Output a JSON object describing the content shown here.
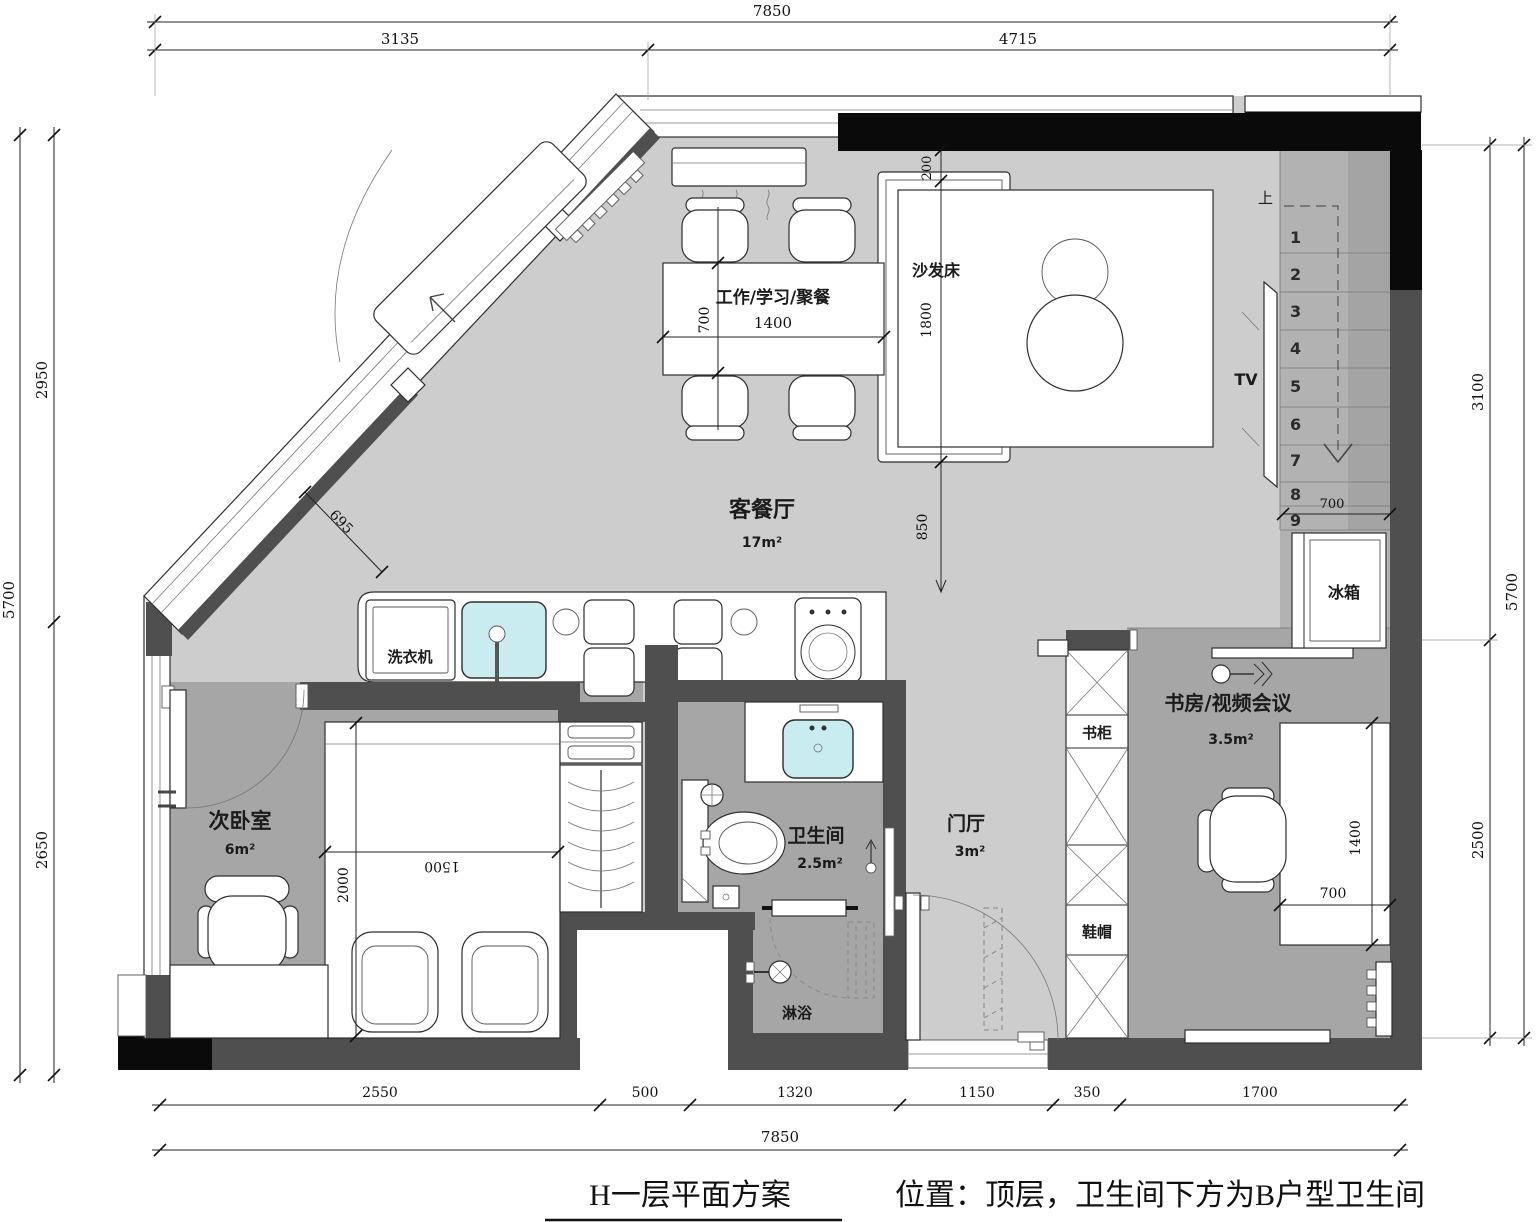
{
  "title": {
    "plan": "H一层平面方案",
    "note": "位置：顶层，卫生间下方为B户型卫生间"
  },
  "rooms": {
    "living": {
      "name": "客餐厅",
      "area": "17m²"
    },
    "bedroom": {
      "name": "次卧室",
      "area": "6m²"
    },
    "bathroom": {
      "name": "卫生间",
      "area": "2.5m²"
    },
    "hall": {
      "name": "门厅",
      "area": "3m²"
    },
    "study": {
      "name": "书房/视频会议",
      "area": "3.5m²"
    },
    "shower": {
      "name": "淋浴"
    }
  },
  "furniture": {
    "sofa_bed": "沙发床",
    "work_table": "工作/学习/聚餐",
    "washer": "洗衣机",
    "fridge": "冰箱",
    "tv": "TV",
    "bookcase": "书柜",
    "shoe_cabinet": "鞋帽"
  },
  "stairs": {
    "up": "上",
    "width": "700",
    "steps": [
      "1",
      "2",
      "3",
      "4",
      "5",
      "6",
      "7",
      "8",
      "9"
    ]
  },
  "dims": {
    "top": {
      "overall": "7850",
      "left": "3135",
      "right": "4715"
    },
    "left": {
      "overall": "5700",
      "top": "2950",
      "bottom": "2650"
    },
    "right": {
      "overall": "5700",
      "top": "3100",
      "bottom": "2500"
    },
    "bottom": {
      "overall": "7850",
      "segments": [
        "2550",
        "500",
        "1320",
        "1150",
        "350",
        "1700"
      ]
    },
    "interior": {
      "table_len": "1400",
      "table_dep": "700",
      "sofa_off": "200",
      "sofa_len": "1800",
      "living_gap": "850",
      "diag": "695",
      "bed_len": "2000",
      "bed_wid": "1500",
      "desk_len": "1400",
      "desk_dep": "700"
    }
  }
}
